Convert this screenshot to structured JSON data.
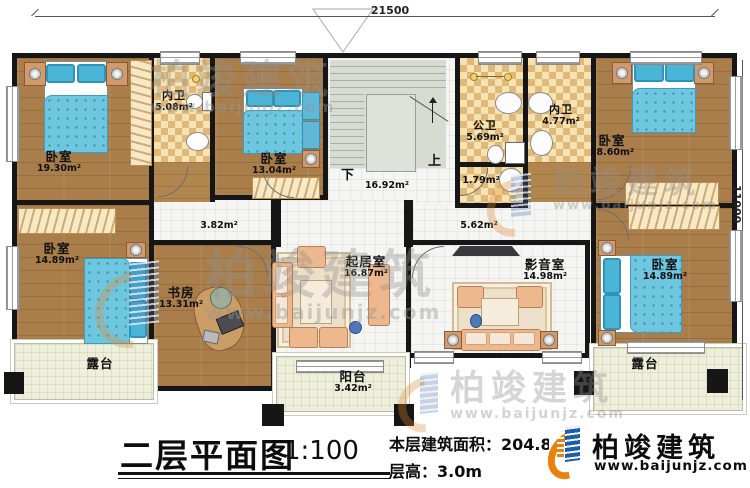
{
  "dimensions": {
    "top": "21500",
    "right": "11000"
  },
  "stair": {
    "up": "上",
    "down": "下"
  },
  "rooms": [
    {
      "name": "卧室",
      "area": "19.30m²"
    },
    {
      "name": "内卫",
      "area": "5.08m²"
    },
    {
      "name": "卧室",
      "area": "13.04m²"
    },
    {
      "name": "",
      "area": "16.92m²"
    },
    {
      "name": "公卫",
      "area": "5.69m²"
    },
    {
      "name": "",
      "area": "1.79m²"
    },
    {
      "name": "内卫",
      "area": "4.77m²"
    },
    {
      "name": "卧室",
      "area": "18.60m²"
    },
    {
      "name": "",
      "area": "3.82m²"
    },
    {
      "name": "",
      "area": "5.62m²"
    },
    {
      "name": "卧室",
      "area": "14.89m²"
    },
    {
      "name": "书房",
      "area": "13.31m²"
    },
    {
      "name": "起居室",
      "area": "16.87m²"
    },
    {
      "name": "影音室",
      "area": "14.98m²"
    },
    {
      "name": "卧室",
      "area": "14.89m²"
    },
    {
      "name": "露台",
      "area": ""
    },
    {
      "name": "阳台",
      "area": "3.42m²"
    },
    {
      "name": "露台",
      "area": ""
    }
  ],
  "title_block": {
    "title": "二层平面图",
    "scale": "1:100",
    "floor_area": "本层建筑面积：204.8m²",
    "floor_height": "层高：3.0m"
  },
  "logo": {
    "name": "柏竣建筑",
    "site": "www.baijunjz.com"
  },
  "watermark": {
    "text": "柏竣建筑",
    "site": "www.baijunjz.com"
  }
}
